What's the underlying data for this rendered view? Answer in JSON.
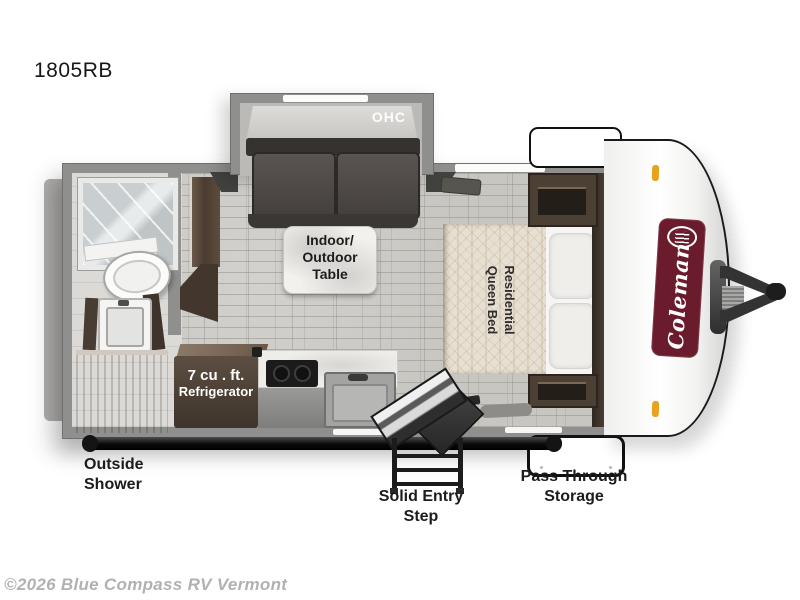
{
  "page": {
    "model": "1805RB",
    "watermark": "©2026 Blue Compass RV Vermont"
  },
  "brand": {
    "name": "Coleman"
  },
  "labels": {
    "ohc": "OHC",
    "table": "Indoor/\nOutdoor\nTable",
    "bed": "Residential\nQueen Bed",
    "fridge_size": "7 cu . ft.",
    "fridge_name": "Refrigerator",
    "outside_shower": "Outside\nShower",
    "entry_step": "Solid Entry\nStep",
    "pass_through": "Pass Through\nStorage"
  },
  "colors": {
    "brand_badge": "#6b1c2c",
    "marker_light": "#e7a31d",
    "wall": "#8f8f8d",
    "wood": "#4b3f35",
    "floor_tile": "#c8c6c1"
  }
}
